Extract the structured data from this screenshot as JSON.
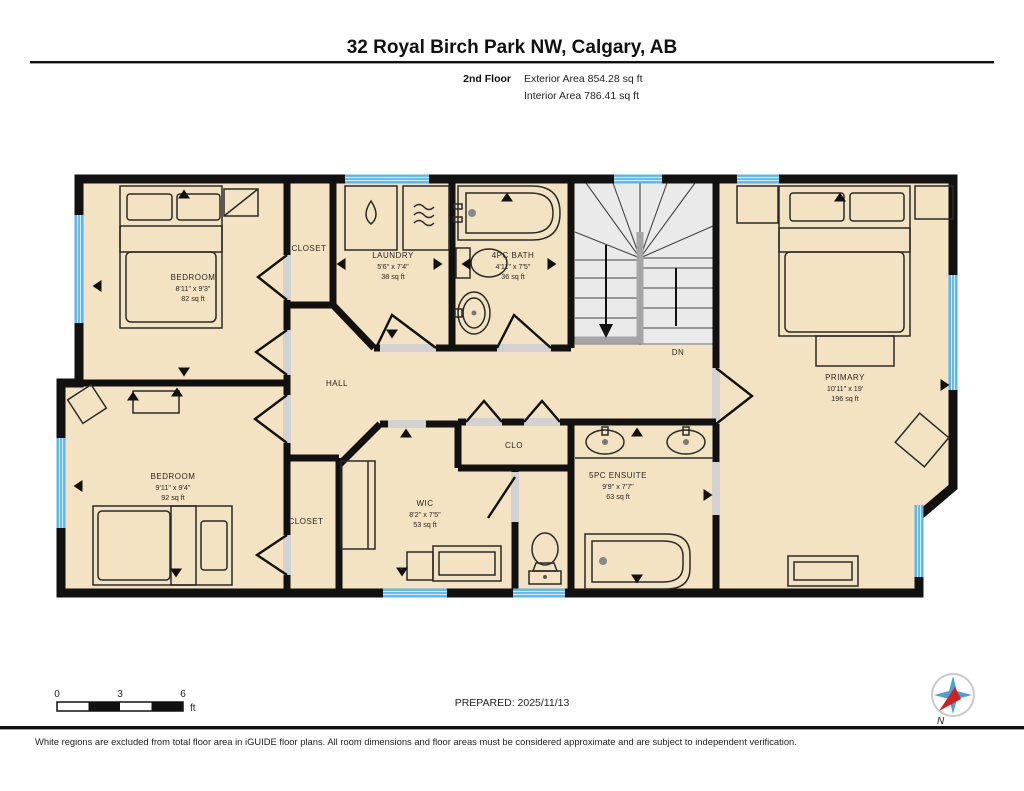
{
  "header": {
    "title": "32 Royal Birch Park NW, Calgary, AB",
    "floor_label": "2nd Floor",
    "exterior_area": "Exterior Area 854.28 sq ft",
    "interior_area": "Interior Area 786.41 sq ft"
  },
  "rooms": {
    "bedroom_tl": {
      "name": "BEDROOM",
      "dims": "8'11\" x 9'3\"",
      "area": "82 sq ft"
    },
    "closet_tl": {
      "name": "CLOSET"
    },
    "laundry": {
      "name": "LAUNDRY",
      "dims": "5'6\" x 7'4\"",
      "area": "38 sq ft"
    },
    "bath": {
      "name": "4PC BATH",
      "dims": "4'11\" x 7'5\"",
      "area": "36 sq ft"
    },
    "stairs": {
      "label": "DN"
    },
    "hall": {
      "name": "HALL"
    },
    "clo": {
      "name": "CLO"
    },
    "primary": {
      "name": "PRIMARY",
      "dims": "10'11\" x 19'",
      "area": "196 sq ft"
    },
    "bedroom_bl": {
      "name": "BEDROOM",
      "dims": "9'11\" x 9'4\"",
      "area": "92 sq ft"
    },
    "closet_bl": {
      "name": "CLOSET"
    },
    "wic": {
      "name": "WIC",
      "dims": "8'2\" x 7'5\"",
      "area": "53 sq ft"
    },
    "ensuite": {
      "name": "5PC ENSUITE",
      "dims": "9'9\" x 7'7\"",
      "area": "63 sq ft"
    }
  },
  "footer": {
    "scale": {
      "tick0": "0",
      "tick3": "3",
      "tick6": "6",
      "unit": "ft"
    },
    "prepared": "PREPARED: 2025/11/13",
    "compass_label": "N",
    "disclaimer": "White regions are excluded from total floor area in iGUIDE floor plans. All room dimensions and floor areas must be considered approximate and are subject to independent verification."
  },
  "colors": {
    "wall": "#111111",
    "floor_tan": "#f4e3c2",
    "window_blue": "#5cb5e6",
    "stair_gray": "#eaeaea",
    "rail_gray": "#a5a5a5",
    "threshold_gray": "#d2d2d2",
    "compass_blue": "#4aa0d8",
    "needle_red": "#cc2222"
  }
}
